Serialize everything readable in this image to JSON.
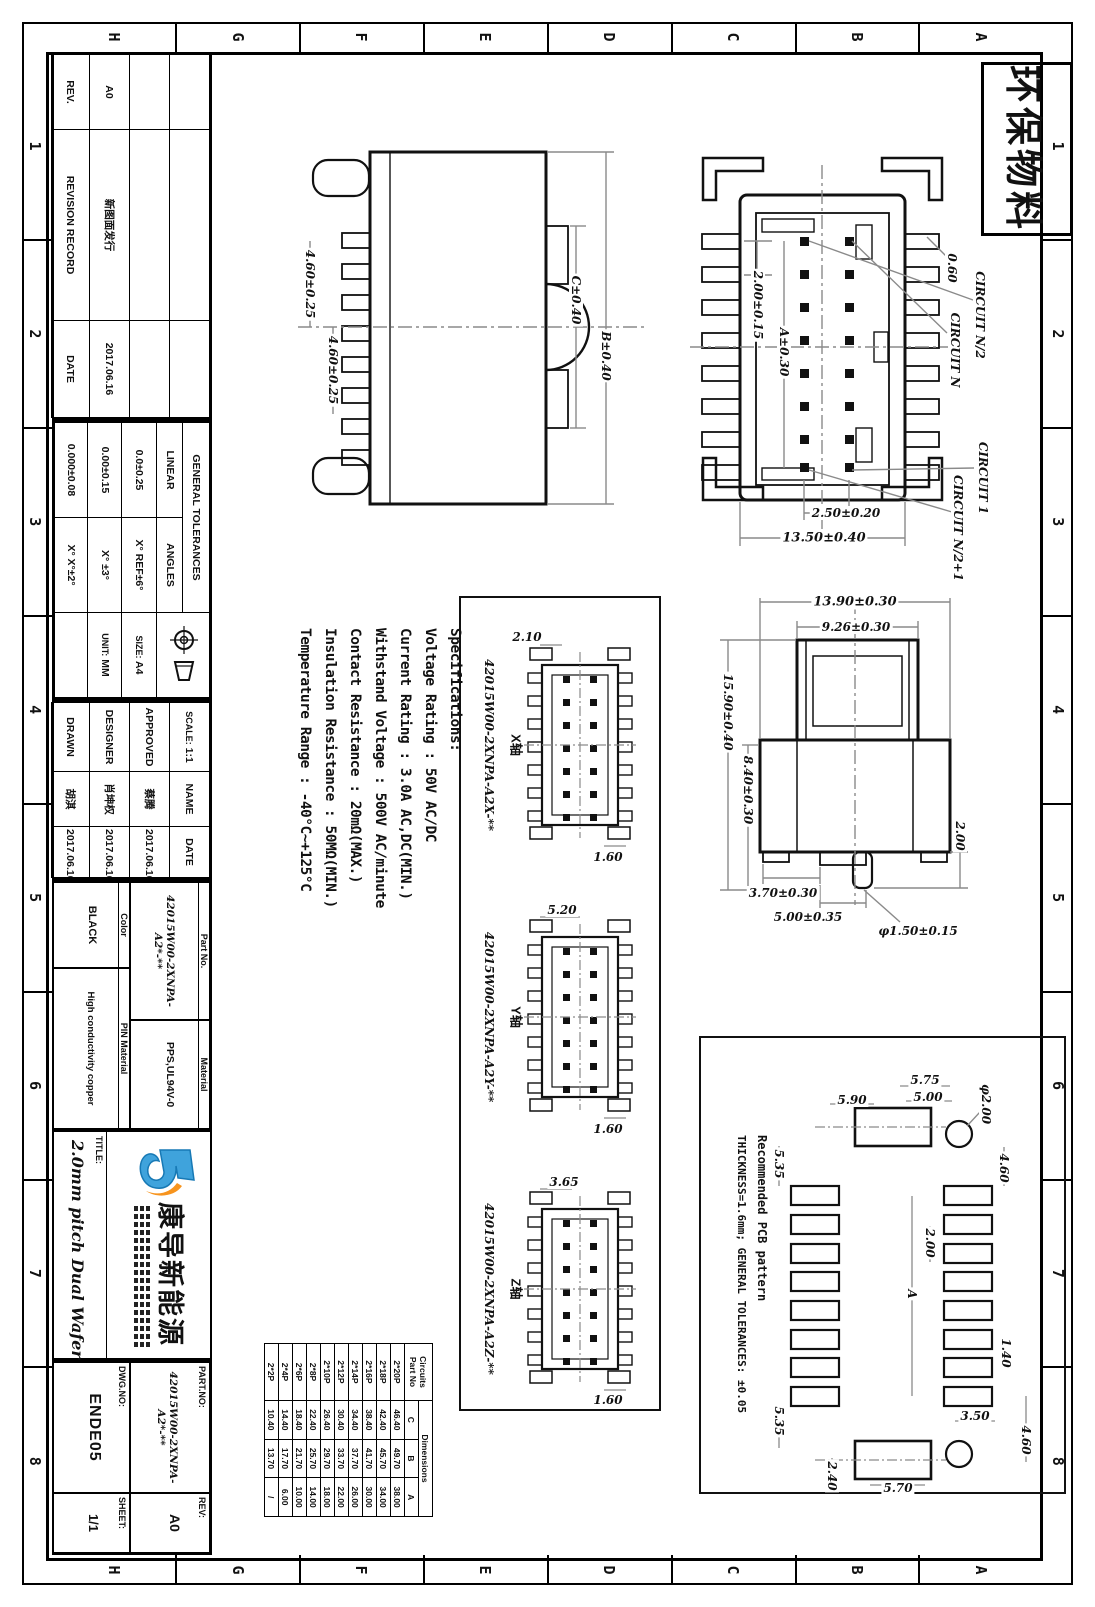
{
  "sheet": {
    "stamp": "环保物料",
    "grid_letters": [
      "A",
      "B",
      "C",
      "D",
      "E",
      "F",
      "G",
      "H"
    ],
    "grid_numbers": [
      "1",
      "2",
      "3",
      "4",
      "5",
      "6",
      "7",
      "8"
    ]
  },
  "revision": {
    "rev_header": "REV.",
    "record_header": "REVISION RECORD",
    "date_header": "DATE",
    "entry_rev": "A0",
    "entry_desc": "新图面发行",
    "entry_date": "2017.06.16"
  },
  "tolerances": {
    "title": "GENERAL TOLERANCES",
    "linear_label": "LINEAR",
    "angles_label": "ANGLES",
    "linear": [
      "0.0±0.25",
      "0.00±0.15",
      "0.000±0.08"
    ],
    "angles": [
      "X° REF±6°",
      "X° ±3°",
      "X° X°±2°"
    ],
    "size_label": "SIZE:",
    "size": "A4",
    "unit_label": "UNIT:",
    "unit": "MM"
  },
  "approval": {
    "scale_label": "SCALE:",
    "scale": "1:1",
    "name_label": "NAME",
    "date_label": "DATE",
    "rows": [
      {
        "role": "APPROVED",
        "name": "蔡腾",
        "date": "2017.06.16"
      },
      {
        "role": "DESIGNER",
        "name": "肖坤权",
        "date": "2017.06.16"
      },
      {
        "role": "DRAWN",
        "name": "胡淇",
        "date": "2017.06.16"
      }
    ]
  },
  "fields": {
    "part_no_label": "Part No.",
    "part_no": "42015W00-2XNPA-A2*-**",
    "material_label": "Material",
    "material": "PPS,UL94V-0",
    "color_label": "Color",
    "color": "BLACK",
    "pin_material_label": "PIN Material",
    "pin_material": "High conductivity copper"
  },
  "company": {
    "name": "康导新能源"
  },
  "titleblock": {
    "title_label": "TITLE:",
    "title": "2.0mm pitch Dual Wafer",
    "part_no_label": "PART.NO:",
    "part_no": "42015W00-2XNPA-A2*-**",
    "rev_label": "REV:",
    "rev": "A0",
    "dwg_no_label": "DWG.NO:",
    "dwg_no": "ENDE05",
    "sheet_label": "SHEET:",
    "sheet": "1/1"
  },
  "specs": {
    "title": "Specifications:",
    "lines": [
      "Voltage Rating : 50V AC/DC",
      "Current Rating : 3.0A AC,DC(MIN.)",
      "Withstand Voltage : 500V AC/minute",
      "Contact Resistance : 20mΩ(MAX.)",
      "Insulation Resistance : 50MΩ(MIN.)",
      "Temperature Range : -40°C~+125°C"
    ]
  },
  "top_view": {
    "dims": [
      "2.00±0.15",
      "A±0.30",
      "0.60",
      "2.50±0.20",
      "13.50±0.40"
    ],
    "callouts": [
      "CIRCUIT N/2",
      "CIRCUIT N",
      "CIRCUIT 1",
      "CIRCUIT N/2+1"
    ]
  },
  "front_view": {
    "dims": [
      "13.90±0.30",
      "9.26±0.30",
      "15.90±0.40",
      "8.40±0.30",
      "3.70±0.30",
      "5.00±0.35",
      "φ1.50±0.15",
      "2.00"
    ]
  },
  "side_view": {
    "dims": [
      "4.60±0.25",
      "4.60±0.25",
      "C±0.40",
      "B±0.40"
    ]
  },
  "axis_views": {
    "items": [
      {
        "axis": "X轴",
        "part_no": "42015W00-2XNPA-A2X-**",
        "dim_top": "2.10",
        "dim_bottom": "1.60"
      },
      {
        "axis": "Y轴",
        "part_no": "42015W00-2XNPA-A2Y-**",
        "dim_top": "5.20",
        "dim_bottom": "1.60"
      },
      {
        "axis": "Z轴",
        "part_no": "42015W00-2XNPA-A2Z-**",
        "dim_top": "3.65",
        "dim_bottom": "1.60"
      }
    ]
  },
  "pcb": {
    "note_line1": "Recommended PCB pattern",
    "note_line2": "THICKNESS=1.6mm; GENERAL TOLERANCES: ±0.05",
    "dims": [
      "5.75",
      "5.00",
      "5.90",
      "φ2.00",
      "5.35",
      "4.60",
      "2.00",
      "A",
      "1.40",
      "3.50",
      "4.60",
      "5.35",
      "2.40",
      "5.70"
    ]
  },
  "circuit_table": {
    "header_circuits": "Circuits",
    "header_part_no": "Part No",
    "header_dimensions": "Dimensions",
    "cols": [
      "C",
      "B",
      "A"
    ],
    "rows": [
      [
        "2*20P",
        "46.40",
        "49.70",
        "38.00"
      ],
      [
        "2*18P",
        "42.40",
        "45.70",
        "34.00"
      ],
      [
        "2*16P",
        "38.40",
        "41.70",
        "30.00"
      ],
      [
        "2*14P",
        "34.40",
        "37.70",
        "26.00"
      ],
      [
        "2*12P",
        "30.40",
        "33.70",
        "22.00"
      ],
      [
        "2*10P",
        "26.40",
        "29.70",
        "18.00"
      ],
      [
        "2*8P",
        "22.40",
        "25.70",
        "14.00"
      ],
      [
        "2*6P",
        "18.40",
        "21.70",
        "10.00"
      ],
      [
        "2*4P",
        "14.40",
        "17.70",
        "6.00"
      ],
      [
        "2*2P",
        "10.40",
        "13.70",
        "/"
      ]
    ]
  }
}
